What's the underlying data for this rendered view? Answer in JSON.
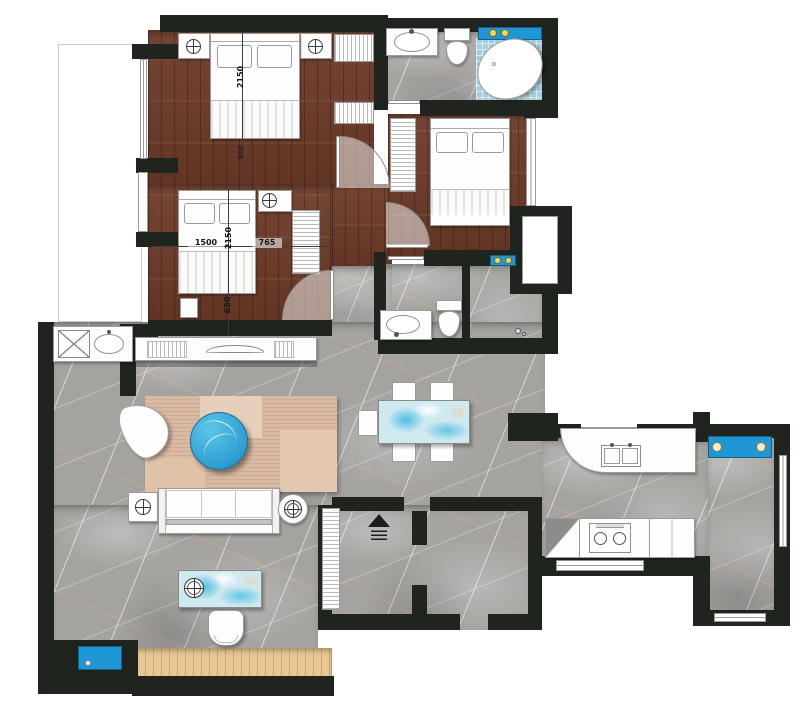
{
  "plan": {
    "title": "apartment-floor-plan",
    "dimension_labels": {
      "master_bed_length": "2150",
      "master_bed_clearance": "866",
      "second_bed_width": "1500",
      "second_bed_length": "2150",
      "second_gap_right": "765",
      "second_gap_foot": "650"
    }
  },
  "colors": {
    "wall": "#20241e",
    "marble": "#a5a3a0",
    "wood-dark": "#6d3a28",
    "wood-light": "#e8c795",
    "mosaic-blue": "#a7cede",
    "marble-blue": "#cfe9f1",
    "accent-blue": "#1f97d4",
    "rug": "#d9b9a2",
    "table-blue": "#2e9ed2"
  }
}
